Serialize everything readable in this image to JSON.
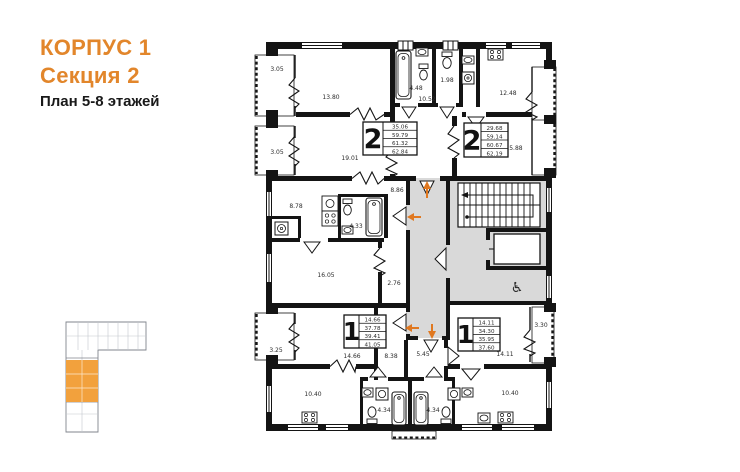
{
  "header": {
    "building": "КОРПУС 1",
    "section": "Секция 2",
    "floors": "План 5-8 этажей"
  },
  "colors": {
    "accent_orange": "#e2862b",
    "section_highlight": "#f2a13d",
    "common_area_gray": "#d9d9d9",
    "wall_black": "#141414"
  },
  "apartments": {
    "two_room_left": {
      "number": "2",
      "values": [
        "35.06",
        "59.79",
        "61.32",
        "62.84"
      ]
    },
    "two_room_right": {
      "number": "2",
      "values": [
        "29.68",
        "59.14",
        "60.67",
        "62.19"
      ]
    },
    "one_room_left": {
      "number": "1",
      "values": [
        "14.66",
        "37.78",
        "39.41",
        "41.05"
      ]
    },
    "one_room_right": {
      "number": "1",
      "values": [
        "14.11",
        "34.30",
        "35.95",
        "37.60"
      ]
    }
  },
  "rooms": {
    "balcony_top_left": "3.05",
    "balcony_mid_left": "3.05",
    "room_top_left": "13.80",
    "bathroom_top": "4.48",
    "wc_top": "1.98",
    "hall_top": "10.52",
    "kitchen_top_right": "12.48",
    "room_19": "19.01",
    "room_15": "15.88",
    "kitchen_mid_left": "8.78",
    "hall_mid": "8.86",
    "bathroom_mid": "4.33",
    "room_16": "16.05",
    "corridor_small": "2.76",
    "balcony_bottom_left": "3.25",
    "room_14_66": "14.66",
    "hall_bottom_left": "8.38",
    "kitchen_bottom_left": "10.40",
    "bathroom_bottom_left": "4.34",
    "bathroom_bottom_right": "4.34",
    "hall_bottom_right": "5.45",
    "room_14_11": "14.11",
    "balcony_bottom_right": "3.30",
    "kitchen_bottom_right": "10.40"
  },
  "icons": {
    "wheelchair": "♿"
  }
}
